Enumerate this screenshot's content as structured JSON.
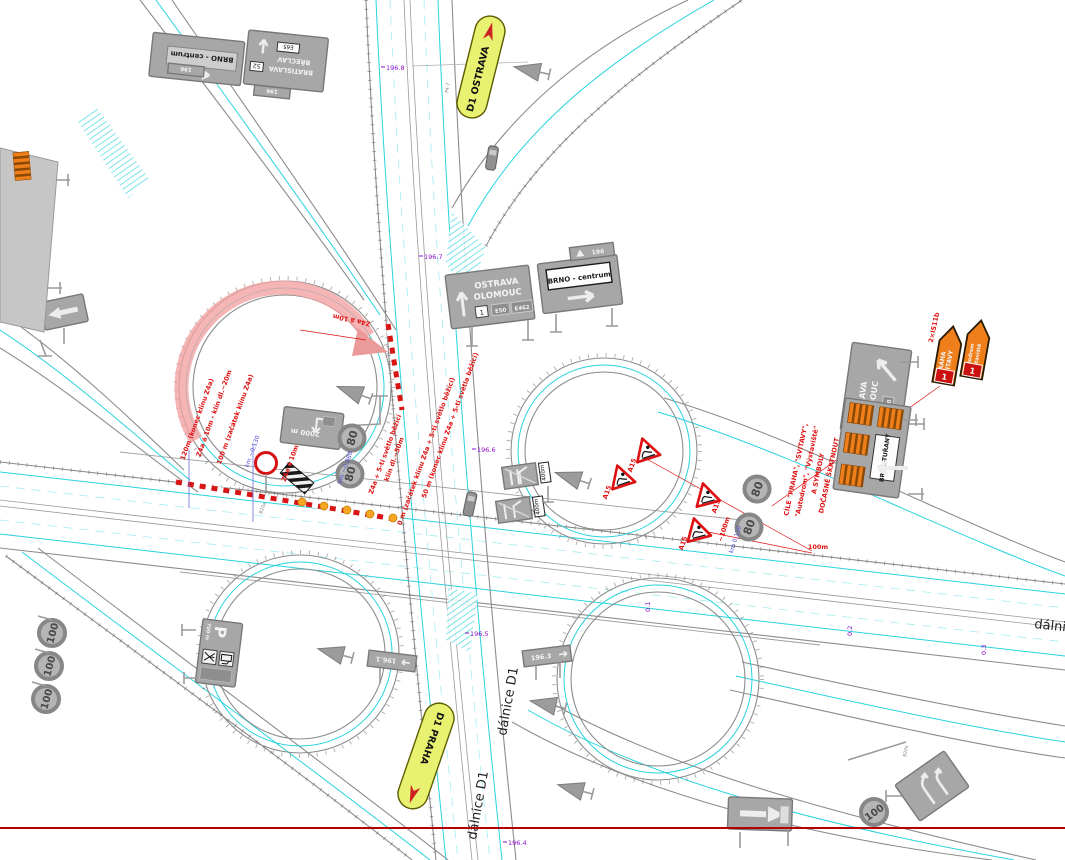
{
  "meta": {
    "type": "traffic-engineering-plan-d1-interchange"
  },
  "pills": {
    "ostrava": "D1 OSTRAVA",
    "praha": "D1 PRAHA"
  },
  "roads": {
    "dalnice_d1": "dálnice D1",
    "dalnice_edge": "dálnice"
  },
  "km_marks": {
    "k1968": "196.8",
    "k1967": "196.7",
    "k1966": "196.6",
    "k1965": "196.5",
    "k1964": "196.4",
    "h01": "0.1",
    "h02": "0.2",
    "h03": "0.3",
    "exit_a": "196.1",
    "exit_b": "196.3",
    "plate196": "196"
  },
  "signs": {
    "brno_centrum": "BRNO - centrum",
    "bratislava": "BRATISLAVA",
    "route52": "52",
    "breclav": "BŘECLAV",
    "e65": "E65",
    "ostrava": "OSTRAVA",
    "olomouc": "OLOMOUC",
    "route1": "1",
    "e50": "E50",
    "e462": "E462",
    "brno_turany": "BRNO-TUŘANY",
    "praha": "PRAHA",
    "svitavy": "SVITAVY",
    "autodrom": "Autodrom",
    "vystaviste": "Výstaviště",
    "d2000": "2000 m",
    "p": "P",
    "p700": "700 m",
    "m400": "400m",
    "speed80": "80",
    "speed100": "100",
    "a15": "A15"
  },
  "notes": {
    "red_n1": "120m (konec klínu Z4a)",
    "red_n2": "Z4a á 10m - klín dl.~20m",
    "red_n3": "100 m (začátek klínu Z4a)",
    "red_n4": "Z4a á 10m",
    "red_n5": "Z4a á 10m",
    "red_n6": "50 m (konec klínu Z4a + 5-ti světla běžící)",
    "red_n7": "Z4a + 5-ti světlo běžící",
    "red_n8": "klín dl.~50m",
    "red_n9": "0 m (začátek klínu Z4a + 5-ti světlo běžící)",
    "red_100a": "~100m",
    "red_100b": "100m",
    "red_is": "2×IS11b",
    "strike1": "CÍLE \"PRAHA\", \"SVITAVY\",",
    "strike2": "\"Autodrom\", \"Výstaviště\"",
    "strike3": "A SYMBOLY",
    "strike4": "DOČASNĚ ŠKRTNOUT",
    "blue_k080": "km ~0,080",
    "blue_k130a": "km ~0,130",
    "blue_k130b": "km 0,130",
    "code_b20a": "B20a",
    "code_p47": "P4-7"
  },
  "colors": {
    "cyan": "#29d3de",
    "cyan_light": "#a5ecf2",
    "pink": "#f2a2a2",
    "red": "#e01212",
    "purple": "#8a10c8",
    "blue": "#5153d8",
    "yellow": "#e9f171",
    "orange": "#ef7f1b",
    "sign_gray": "#a7a7a7",
    "edge_gray": "#8c8c8c",
    "border_red": "#b40000"
  }
}
